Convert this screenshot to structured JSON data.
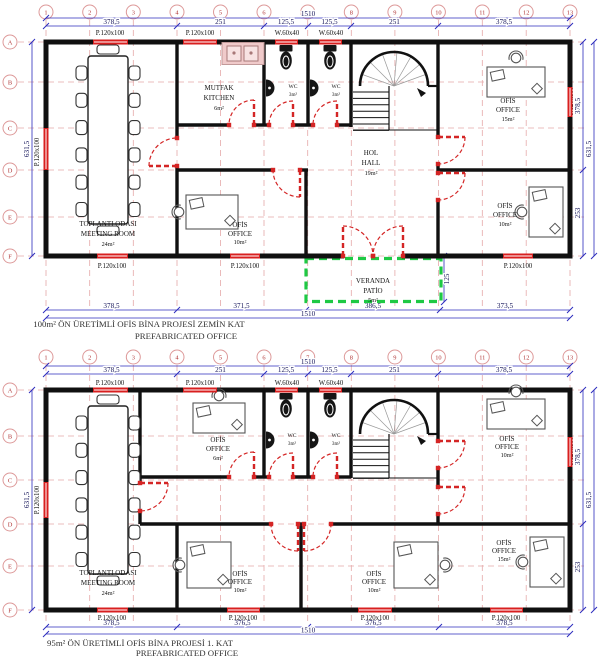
{
  "drawing_title": "Prefabricated office building floor plans",
  "grid": {
    "columns": [
      "1",
      "2",
      "3",
      "4",
      "5",
      "6",
      "7",
      "8",
      "9",
      "10",
      "11",
      "12",
      "13"
    ],
    "rows": [
      "A",
      "B",
      "C",
      "D",
      "E",
      "F"
    ]
  },
  "plan1": {
    "caption": [
      "100m² ÖN ÜRETİMLİ OFİS BİNA PROJESİ ZEMİN KAT",
      "PREFABRICATED OFFICE"
    ],
    "dims": {
      "total": "1510",
      "top": [
        "378,5",
        "251",
        "125,5",
        "125,5",
        "251",
        "378,5"
      ],
      "bottom": [
        "378,5",
        "371,5",
        "386,5",
        "373,5"
      ],
      "left_total": "631,5",
      "right_total": "631,5",
      "right_segments": [
        "378,5",
        "253"
      ],
      "veranda_depth": "125"
    },
    "windows": {
      "top": [
        "P.120x100",
        "P.120x100",
        "W.60x40",
        "W.60x40"
      ],
      "bottom": [
        "P.120x100",
        "P.120x100",
        "P.120x100"
      ],
      "left": "P.120x100",
      "right": "P.120x100"
    },
    "rooms": {
      "meeting": {
        "l1": "TOPLANTI ODASI",
        "l2": "MEETING ROOM",
        "l3": "24m²"
      },
      "kitchen": {
        "l1": "MUTFAK",
        "l2": "KITCHEN",
        "l3": "6m²"
      },
      "wc1": {
        "l1": "WC",
        "l2": "3m²"
      },
      "wc2": {
        "l1": "WC",
        "l2": "3m²"
      },
      "hall": {
        "l1": "HOL",
        "l2": "HALL",
        "l3": "19m²"
      },
      "office_tr": {
        "l1": "OFİS",
        "l2": "OFFICE",
        "l3": "15m²"
      },
      "office_bc": {
        "l1": "OFİS",
        "l2": "OFFICE",
        "l3": "10m²"
      },
      "office_br": {
        "l1": "OFİS",
        "l2": "OFFICE",
        "l3": "10m²"
      },
      "veranda": {
        "l1": "VERANDA",
        "l2": "PATİO",
        "l3": "5m²"
      }
    }
  },
  "plan2": {
    "caption": [
      "95m² ÖN ÜRETİMLİ OFİS BİNA PROJESİ 1. KAT",
      "PREFABRICATED OFFICE"
    ],
    "dims": {
      "total": "1510",
      "top": [
        "378,5",
        "251",
        "125,5",
        "125,5",
        "251",
        "378,5"
      ],
      "bottom": [
        "378,5",
        "376,5",
        "376,5",
        "378,5"
      ],
      "left_total": "631,5",
      "right_total": "631,5",
      "right_segments": [
        "378,5",
        "253"
      ]
    },
    "windows": {
      "top": [
        "P.120x100",
        "P.120x100",
        "W.60x40",
        "W.60x40"
      ],
      "bottom": [
        "P.120x100",
        "P.120x100",
        "P.120x100",
        "P.120x100"
      ],
      "left": "P.120x100",
      "right": "P.120x100"
    },
    "rooms": {
      "meeting": {
        "l1": "TOPLANTI ODASI",
        "l2": "MEETING ROOM",
        "l3": "24m²"
      },
      "office_tc": {
        "l1": "OFİS",
        "l2": "OFFICE",
        "l3": "6m²"
      },
      "wc1": {
        "l1": "WC",
        "l2": "3m²"
      },
      "wc2": {
        "l1": "WC",
        "l2": "3m²"
      },
      "office_tr": {
        "l1": "OFİS",
        "l2": "OFFICE",
        "l3": "10m²"
      },
      "office_bc1": {
        "l1": "OFİS",
        "l2": "OFFICE",
        "l3": "10m²"
      },
      "office_bc2": {
        "l1": "OFİS",
        "l2": "OFFICE",
        "l3": "10m²"
      },
      "office_br": {
        "l1": "OFİS",
        "l2": "OFFICE",
        "l3": "15m²"
      }
    }
  }
}
